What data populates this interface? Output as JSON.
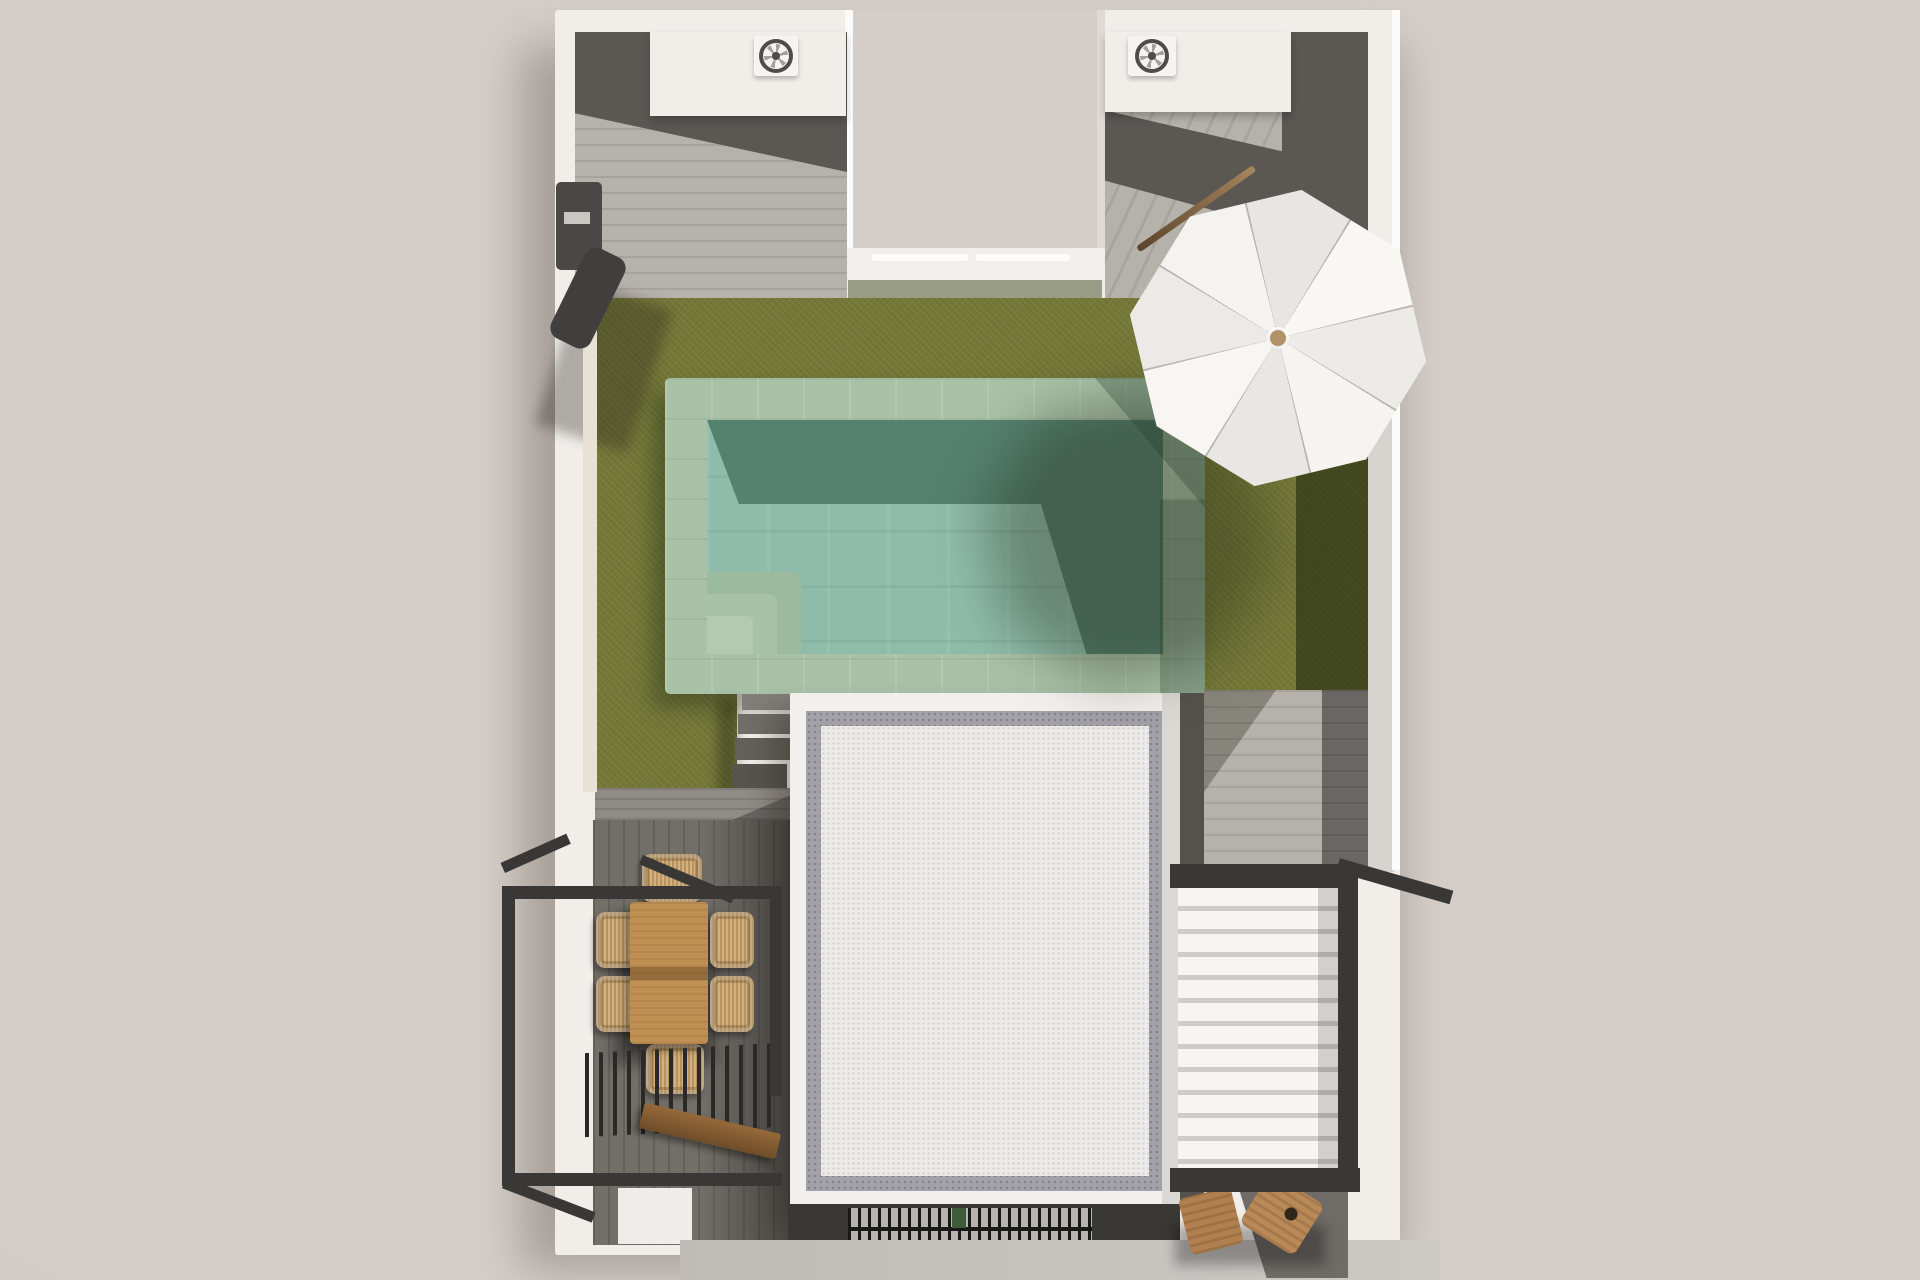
{
  "canvas": {
    "width": 1920,
    "height": 1280
  },
  "palette": {
    "bg": "#d5cec8",
    "bg-edge": "#c3bbb5",
    "wall-white": "#f1eeea",
    "wall-bright": "#fcfbf9",
    "wall-shade": "#d7d3cf",
    "wall-cream": "#e8e2d5",
    "tile-light": "#b5b1ab",
    "tile-dark": "#5b5753",
    "lawn": "#757a39",
    "lawn-shadow": "#39411c",
    "pool-coping": "#a9c2a7",
    "pool-water": "#8fbcaa",
    "pool-water-shadow": "#55816f",
    "pool-step": "#b3cab0",
    "deck-mid": "#726e68",
    "deck-light": "#8f8b85",
    "frame-dark": "#3a3836",
    "wood": "#c09052",
    "wicker": "#c8a36c",
    "roof-white": "#f2f0ed",
    "roof-inner": "#edebe8",
    "gravel": "#a2a0a8",
    "hedge": "#999d85",
    "knob": "#b3926a",
    "pavement": "#c6c2be"
  },
  "scene": {
    "type": "3d-top-view-architectural-render",
    "description": "Top-down 3D render of a white walled villa plot with swimming pool, lawn, parasol, dining terrace, pergolas and flat gravel-edged roof",
    "objects": {
      "plot": {
        "label": "white-walled villa plot"
      },
      "entrance_notch": {
        "label": "street entrance recess with gate tracks"
      },
      "pool": {
        "label": "swimming pool with green stone coping",
        "corner_steps": 3
      },
      "lawn": {
        "label": "green lawn"
      },
      "umbrella": {
        "label": "white octagonal parasol",
        "panels": 8
      },
      "lounger_pole": {
        "label": "wooden pole on patio"
      },
      "ac_units": {
        "label": "rooftop AC fan units",
        "count": 2
      },
      "storage_units": {
        "label": "white rooftop storage volumes",
        "count": 2
      },
      "building": {
        "label": "flat white roof with gravel border"
      },
      "stairs": {
        "label": "garden steps beside roof",
        "treads": 5
      },
      "dining_table": {
        "label": "wooden dining table"
      },
      "dining_chairs": {
        "label": "wicker dining chairs",
        "count": 6
      },
      "balcony_frame": {
        "label": "black steel terrace frame"
      },
      "slatted_pergola": {
        "label": "black slatted pergola"
      },
      "bench": {
        "label": "wooden bench"
      },
      "louvered_pergola": {
        "label": "white louvered pergola",
        "louvers": 12
      },
      "shower": {
        "label": "outdoor shower on left wall"
      },
      "entrance_grate": {
        "label": "entrance drainage grate"
      },
      "stools": {
        "label": "wooden stools",
        "count": 2
      },
      "pavement": {
        "label": "street pavement strip"
      }
    }
  }
}
